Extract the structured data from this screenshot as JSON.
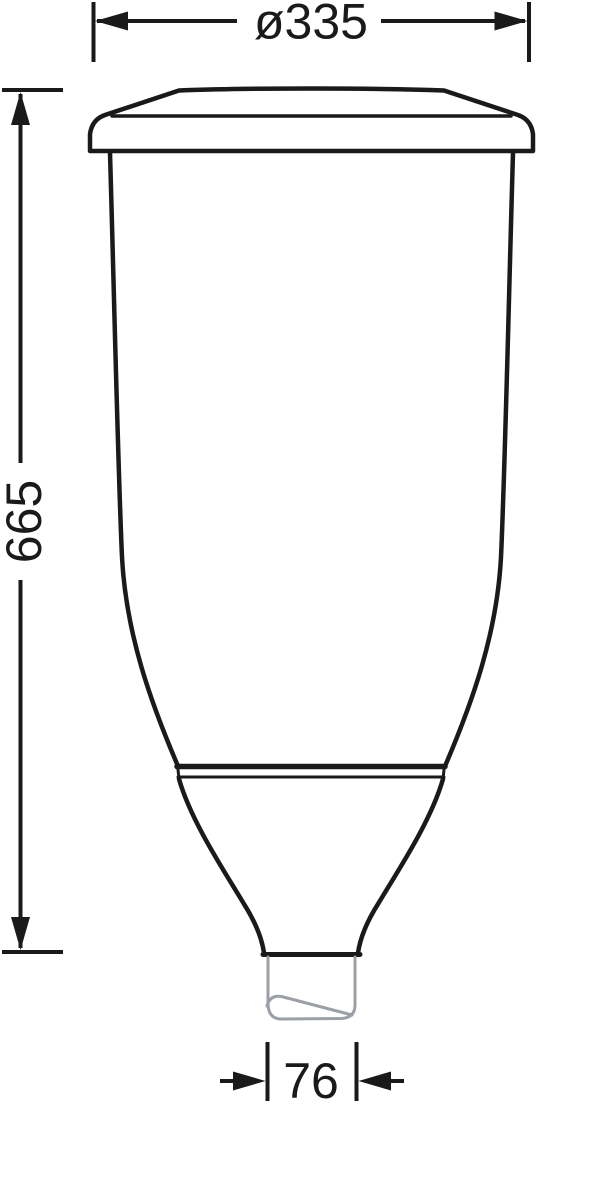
{
  "drawing": {
    "kind": "dimensioned technical line drawing of a tapered post-top luminaire with pole spigot",
    "colors": {
      "outline": "#1a1a1a",
      "pole_gray": "#9aa0a5",
      "background": "#ffffff"
    },
    "dimensions": {
      "diameter": {
        "label": "ø335",
        "value": 335
      },
      "height": {
        "label": "665",
        "value": 665
      },
      "spigot": {
        "label": "76",
        "value": 76
      }
    }
  }
}
